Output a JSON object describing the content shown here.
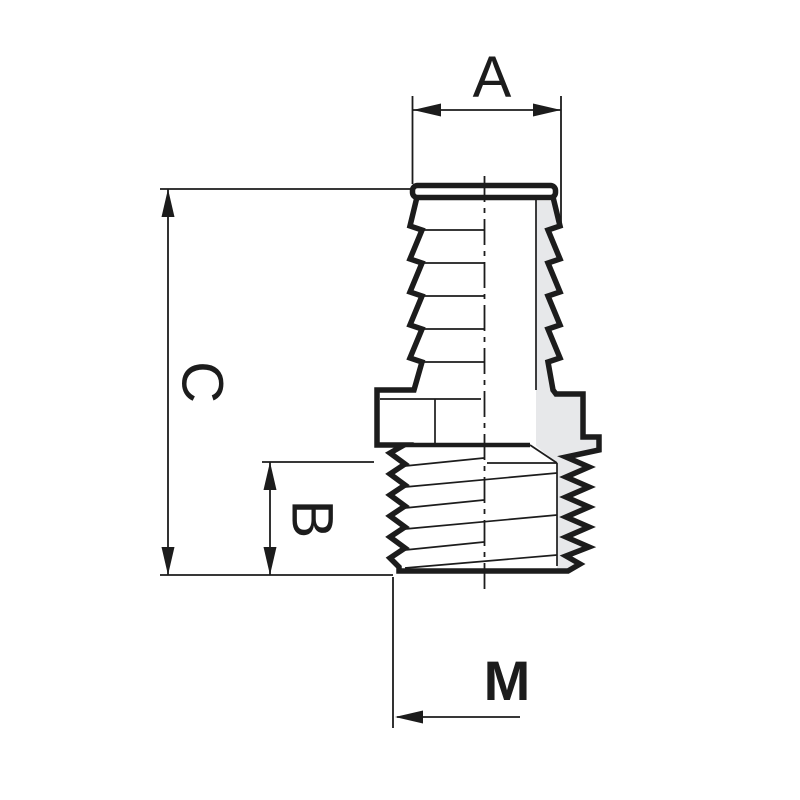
{
  "drawing": {
    "labels": {
      "a": "A",
      "b": "B",
      "c": "C",
      "m": "M"
    },
    "colors": {
      "line": "#1c1c1c",
      "shading": "#e7e8ea",
      "background": "#ffffff"
    }
  }
}
